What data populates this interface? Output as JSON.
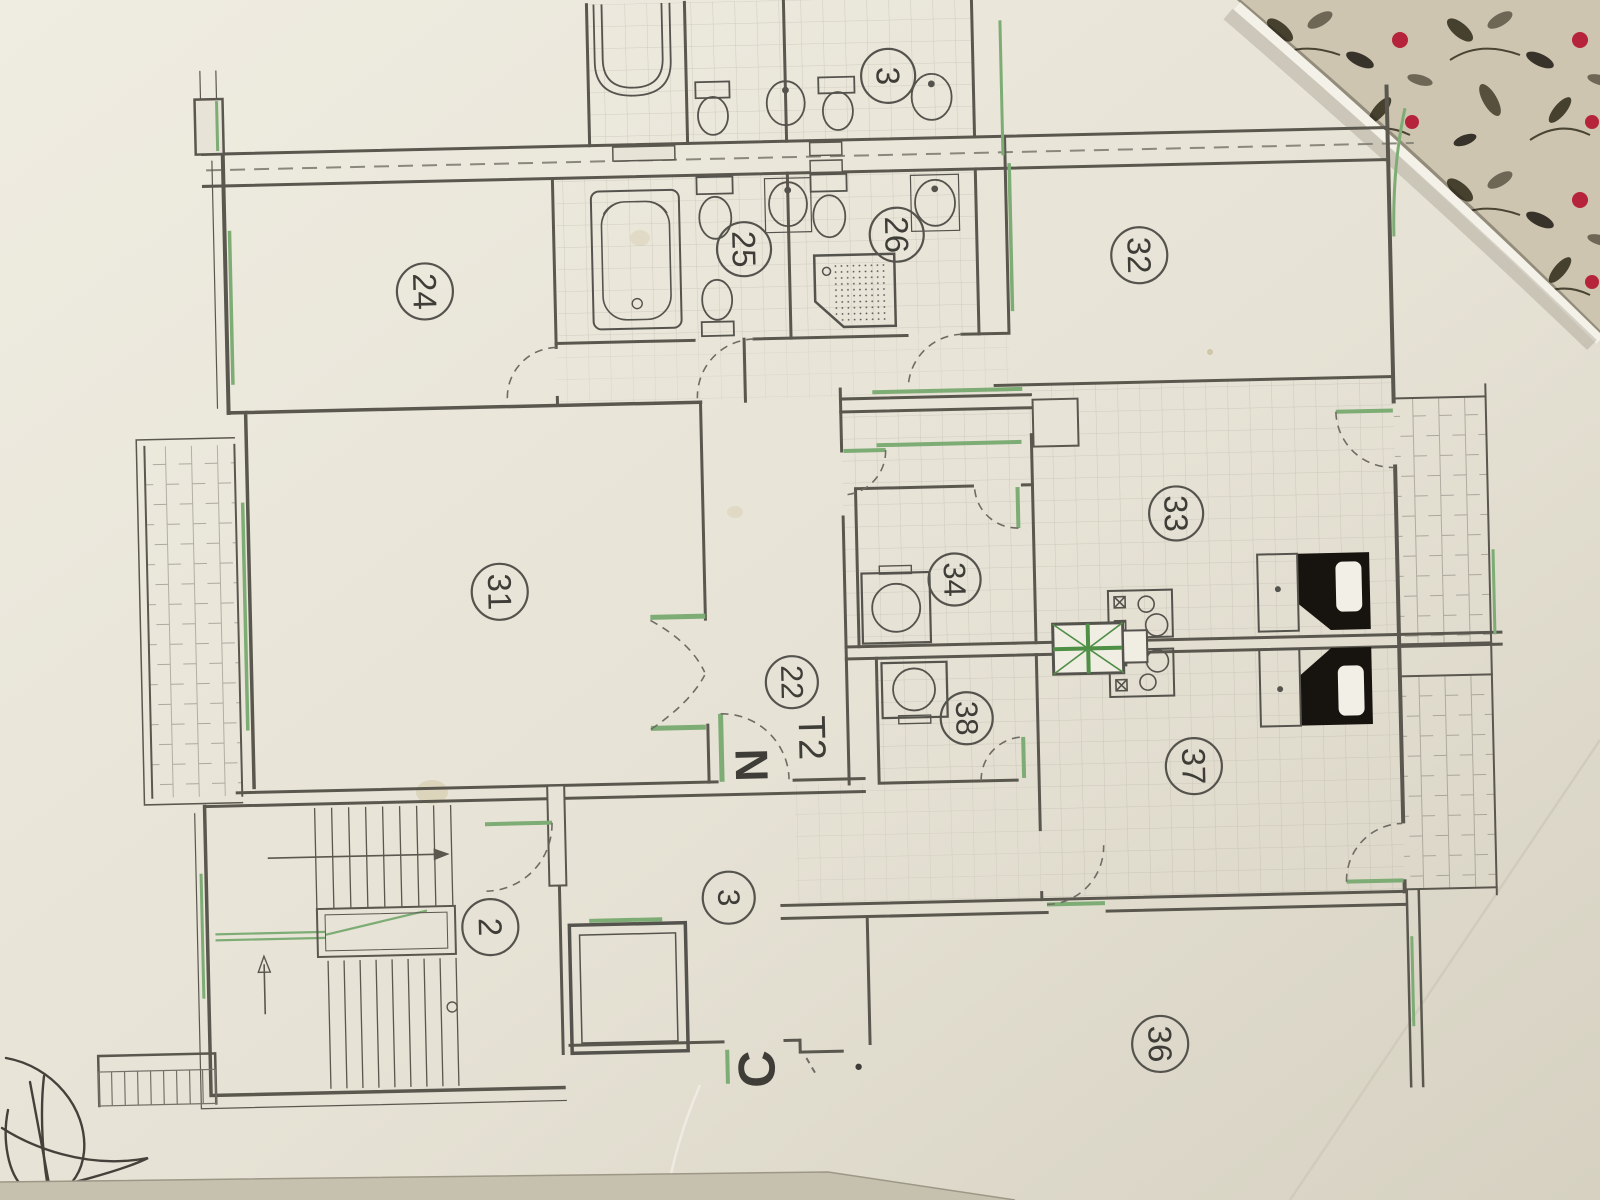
{
  "floorplan": {
    "unit_type_label": "T2",
    "north_label": "N",
    "section_label": "C",
    "labels": {
      "r2": "2",
      "r3": "3",
      "r3top": "3",
      "r22": "22",
      "r24": "24",
      "r25": "25",
      "r26": "26",
      "r31": "31",
      "r32": "32",
      "r33": "33",
      "r34": "34",
      "r36": "36",
      "r37": "37",
      "r38": "38"
    },
    "fixtures": [
      "bathtub",
      "toilet",
      "bidet",
      "washbasin",
      "shower-tray",
      "washing-machine",
      "hob",
      "kitchen-sink",
      "ventilation-shaft",
      "elevator",
      "staircase",
      "balcony",
      "pen-scribble"
    ],
    "colors": {
      "wall": "#5a574f",
      "window_green": "#7dac74",
      "paper": "#e7e3d7",
      "fabric_base": "#cbc3ae",
      "fabric_red": "#b5243a",
      "fixture_black": "#17140f"
    }
  }
}
